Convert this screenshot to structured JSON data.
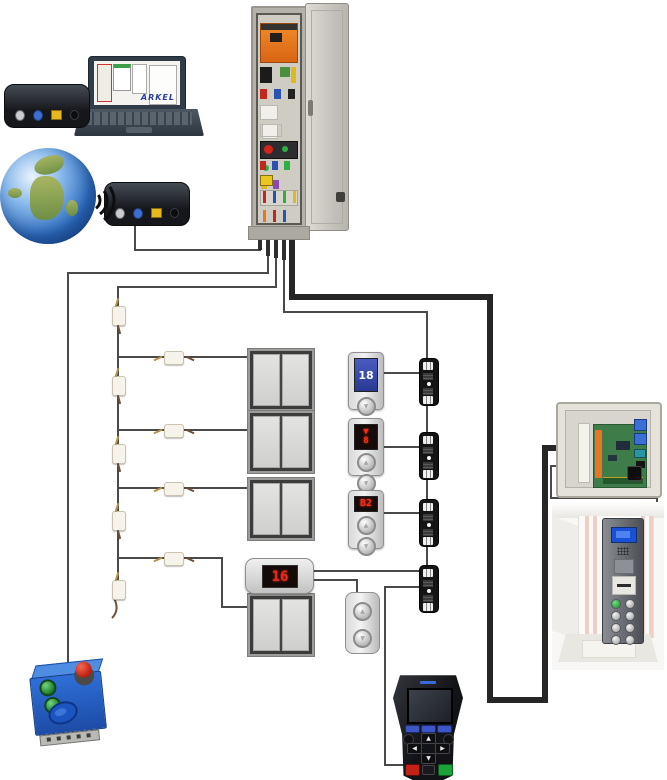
{
  "diagram": {
    "name": "Elevator control system wiring overview",
    "type": "system-diagram"
  },
  "laptop": {
    "brand_text": "ARKEL"
  },
  "landing_panels": [
    {
      "id": "lop-top",
      "display": "18"
    },
    {
      "id": "lop-middle",
      "display_arrow": "▼",
      "display": "8"
    },
    {
      "id": "lop-bottom",
      "display": "B2"
    }
  ],
  "car": {
    "indicator_value": "16"
  },
  "glyphs": {
    "up": "▲",
    "down": "▼",
    "left": "◀",
    "right": "▶"
  },
  "colors": {
    "wire": "#4a4a4a",
    "thick_wire": "#262626",
    "drive_orange": "#e8731e",
    "inspection_box_blue": "#2f6fd8",
    "stop_button_red": "#c01c0c",
    "lcd_blue": "#2a3a92",
    "segment_red": "#ff2a12",
    "pcb_green": "#3e7d4a"
  },
  "icons": {
    "wifi_waves": "three nested arcs",
    "internet_globe": "earth sphere",
    "emergency_stop": "red mushroom button"
  }
}
